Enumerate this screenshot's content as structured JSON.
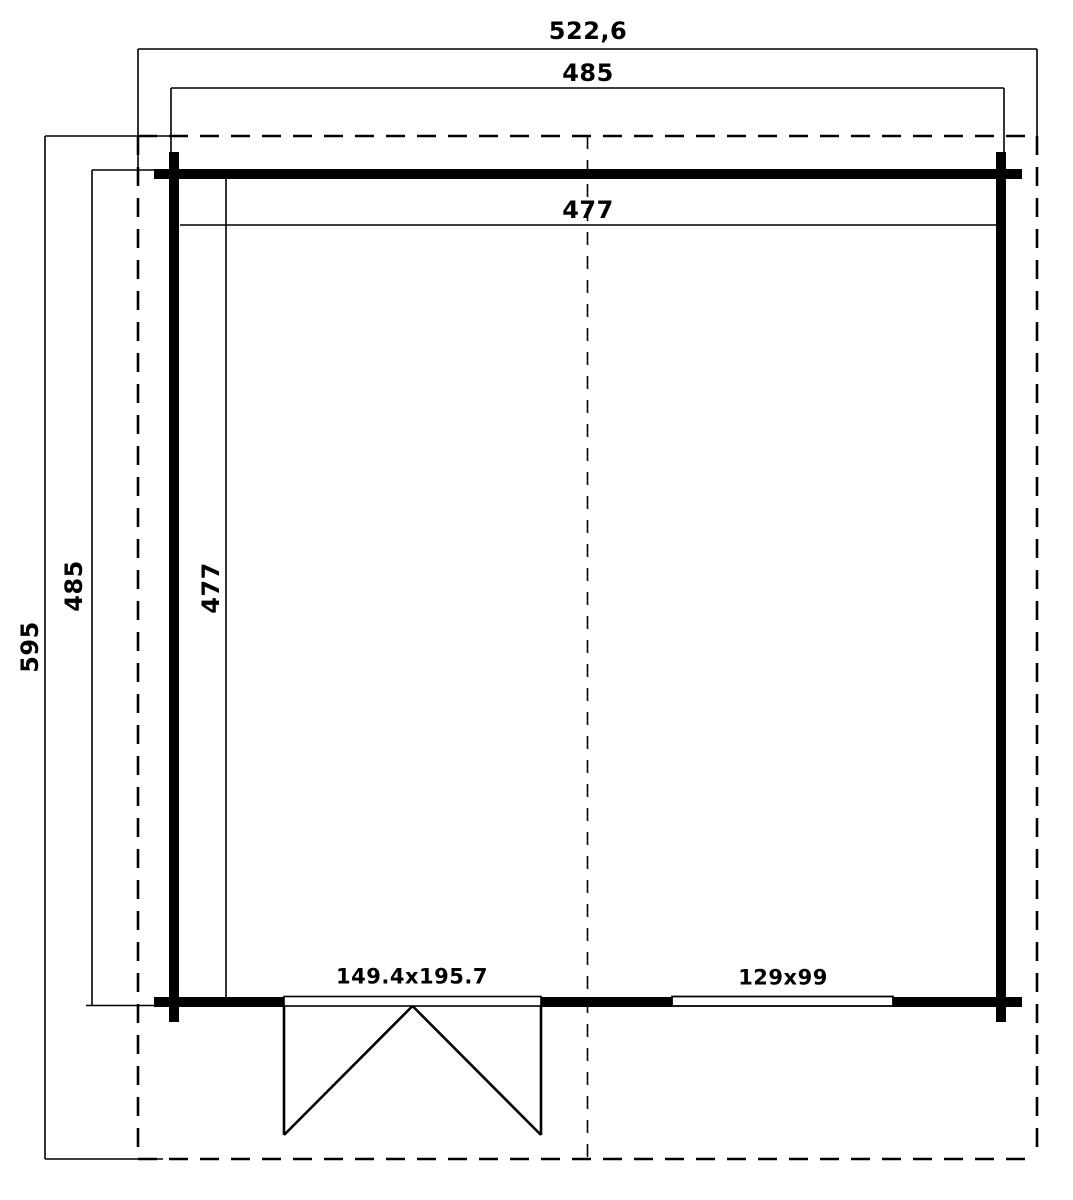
{
  "drawing": {
    "type": "floor-plan",
    "background_color": "#ffffff",
    "line_color": "#000000",
    "dimensions": {
      "roof_width": "522,6",
      "wall_width": "485",
      "interior_width": "477",
      "roof_depth": "595",
      "wall_depth": "485",
      "interior_depth": "477"
    },
    "openings": {
      "door_label": "149.4x195.7",
      "window_label": "129x99"
    }
  }
}
